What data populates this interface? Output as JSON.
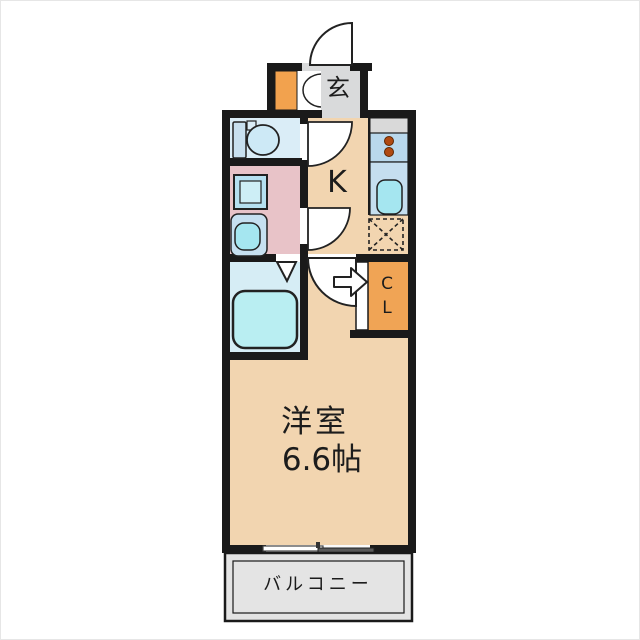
{
  "floorplan": {
    "labels": {
      "genkan": "玄",
      "kitchen": "K",
      "closet_line1": "C",
      "closet_line2": "L",
      "room_name": "洋室",
      "room_size": "6.6帖",
      "balcony": "バルコニー"
    },
    "colors": {
      "wall": "#1a1a1a",
      "room_floor": "#f2d5b0",
      "genkan_floor": "#d9dadb",
      "toilet_room": "#daedf7",
      "washroom": "#e8c3c8",
      "bathroom": "#d6edf5",
      "bathtub": "#b9eef2",
      "closet": "#f0a455",
      "shoe_cabinet": "#f2a24e",
      "kitchen_counter": "#b9d8ec",
      "sink": "#a5e6f0",
      "stove_burner": "#b04a12",
      "balcony": "#e4e4e4"
    },
    "fixtures": [
      "entrance-door-swing-icon",
      "shoe-cabinet-folding-door-icon",
      "toilet-icon",
      "washing-machine-icon",
      "washbasin-icon",
      "bathtub-icon",
      "bathroom-folding-door-icon",
      "door-swing-icon",
      "closet-entry-arrow-icon",
      "stove-burners-icon",
      "kitchen-sink-icon",
      "range-hood-icon",
      "refrigerator-space-icon",
      "sliding-window-icon"
    ]
  }
}
